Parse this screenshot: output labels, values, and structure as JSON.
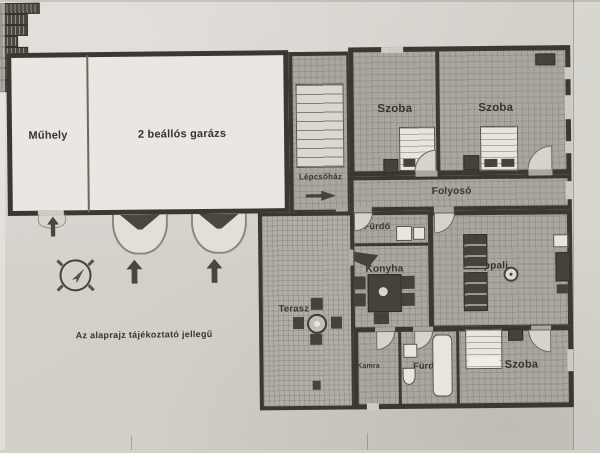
{
  "disclaimer": "Az alaprajz tájékoztató jellegű",
  "rooms": {
    "muhely": "Műhely",
    "garazs": "2 beállós garázs",
    "lepcsohaz": "Lépcsőház",
    "szoba_felso_bal": "Szoba",
    "szoba_felso_jobb": "Szoba",
    "folyoso": "Folyosó",
    "furdo_felso": "Fürdő",
    "konyha": "Konyha",
    "nappali": "Nappali",
    "terasz": "Terasz",
    "kamra": "Kamra",
    "furdo_also": "Fürdő",
    "szoba_also": "Szoba"
  },
  "icons": {
    "compass": "compass-rose-icon",
    "entry_arrow": "up-arrow-icon",
    "stair_arrow": "right-arrow-icon",
    "garage_door": "garage-door-swing-icon",
    "door": "door-arc-icon"
  },
  "colors": {
    "paper": "#d3cfc9",
    "wall": "#3b3732",
    "room_fill": "#aba69f",
    "garage_fill": "#eae7e2",
    "ink": "#37332e"
  }
}
